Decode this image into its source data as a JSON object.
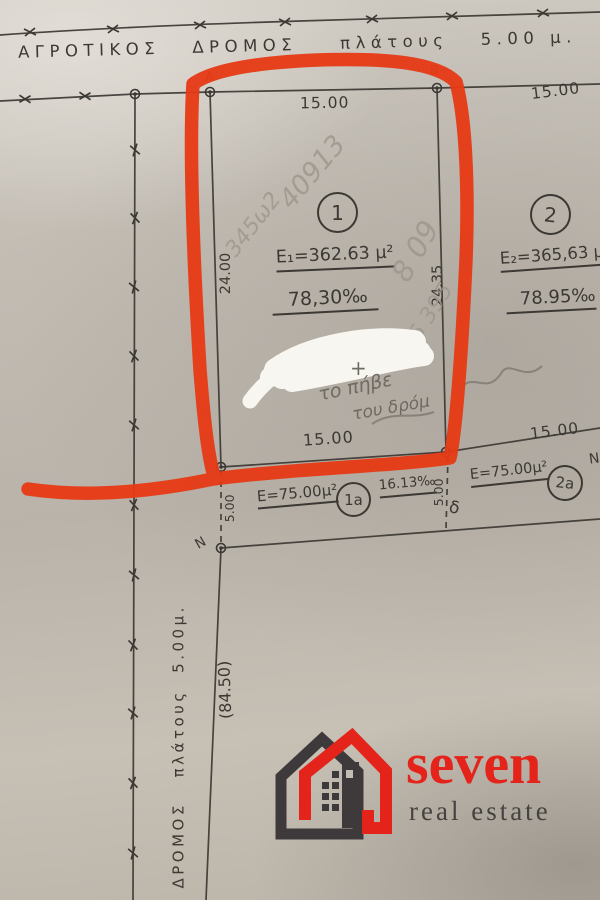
{
  "photo": {
    "paper_color": "#c1bbb2",
    "ink_color": "#3c3833",
    "pencil_color": "#9b958a",
    "marker_red": "#e73914",
    "whiteout_color": "#f8f6f1"
  },
  "plan": {
    "top_road_label": "ΑΓΡΟΤΙΚΟΣ   ΔΡΟΜΟΣ    πλάτους   5.00 μ.",
    "left_road_label": "ΔΡΟΜΟΣ   πλάτους  5.00μ.",
    "left_road_length": "(84.50)",
    "corner_a": "A",
    "corner_b": "B",
    "point_n": "N",
    "point_m": "Ν",
    "delta_mark": "δ",
    "plot1": {
      "number": "1",
      "area": "E₁=362.63 μ²",
      "density": "78,30‰",
      "width_top": "15.00",
      "width_bottom": "15.00",
      "depth_left": "24.00",
      "depth_right": "24.35"
    },
    "plot2": {
      "number": "2",
      "area": "E₂=365,63 μ²",
      "density": "78.95‰",
      "width_top": "15.00",
      "width_bottom": "15.00"
    },
    "strip1": {
      "area": "E=75.00μ²",
      "number": "1a",
      "frontage": "16.13‰",
      "depth": "5.00"
    },
    "strip2": {
      "area": "E=75.00μ²",
      "number": "2a"
    },
    "strip_left_depth": "5.00"
  },
  "handwriting": {
    "h1": "40913",
    "h2": "345ω2",
    "h3": "8 09",
    "h4": "56 395",
    "plus": "+",
    "note_line1": "το πήβε",
    "note_line2": "του δρόμ"
  },
  "logo": {
    "name": "seven",
    "tagline": "real estate",
    "red": "#e4231b",
    "dark": "#3e3a3b"
  }
}
